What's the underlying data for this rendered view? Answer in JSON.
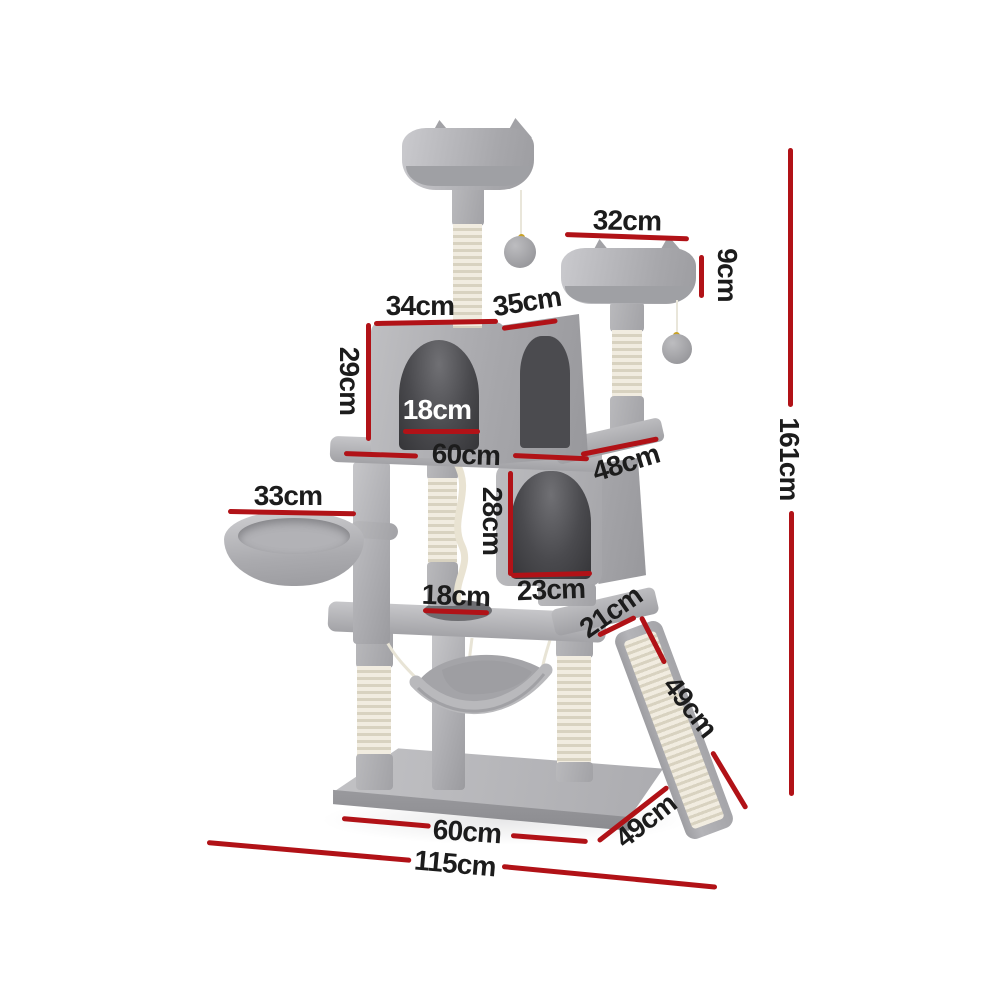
{
  "diagram": {
    "subject": "Grey plush cat tree tower with two condos, perches, basket, hammock and scratching ramp, annotated with dimensions",
    "unit": "cm",
    "accent_color": "#b11217",
    "label_color": "#1c1c1c",
    "measurements": {
      "top_perch_width": "32cm",
      "top_perch_height": "9cm",
      "upper_condo_width": "34cm",
      "upper_condo_depth": "35cm",
      "upper_condo_height": "29cm",
      "upper_condo_door_width": "18cm",
      "upper_platform_width": "60cm",
      "upper_platform_depth": "48cm",
      "lower_condo_door_height": "28cm",
      "lower_condo_door_width": "23cm",
      "basket_width": "33cm",
      "platform_hole_width": "18cm",
      "platform_edge_depth": "21cm",
      "ramp_length": "49cm",
      "base_width": "60cm",
      "base_depth": "49cm",
      "total_width": "115cm",
      "total_height": "161cm"
    }
  }
}
